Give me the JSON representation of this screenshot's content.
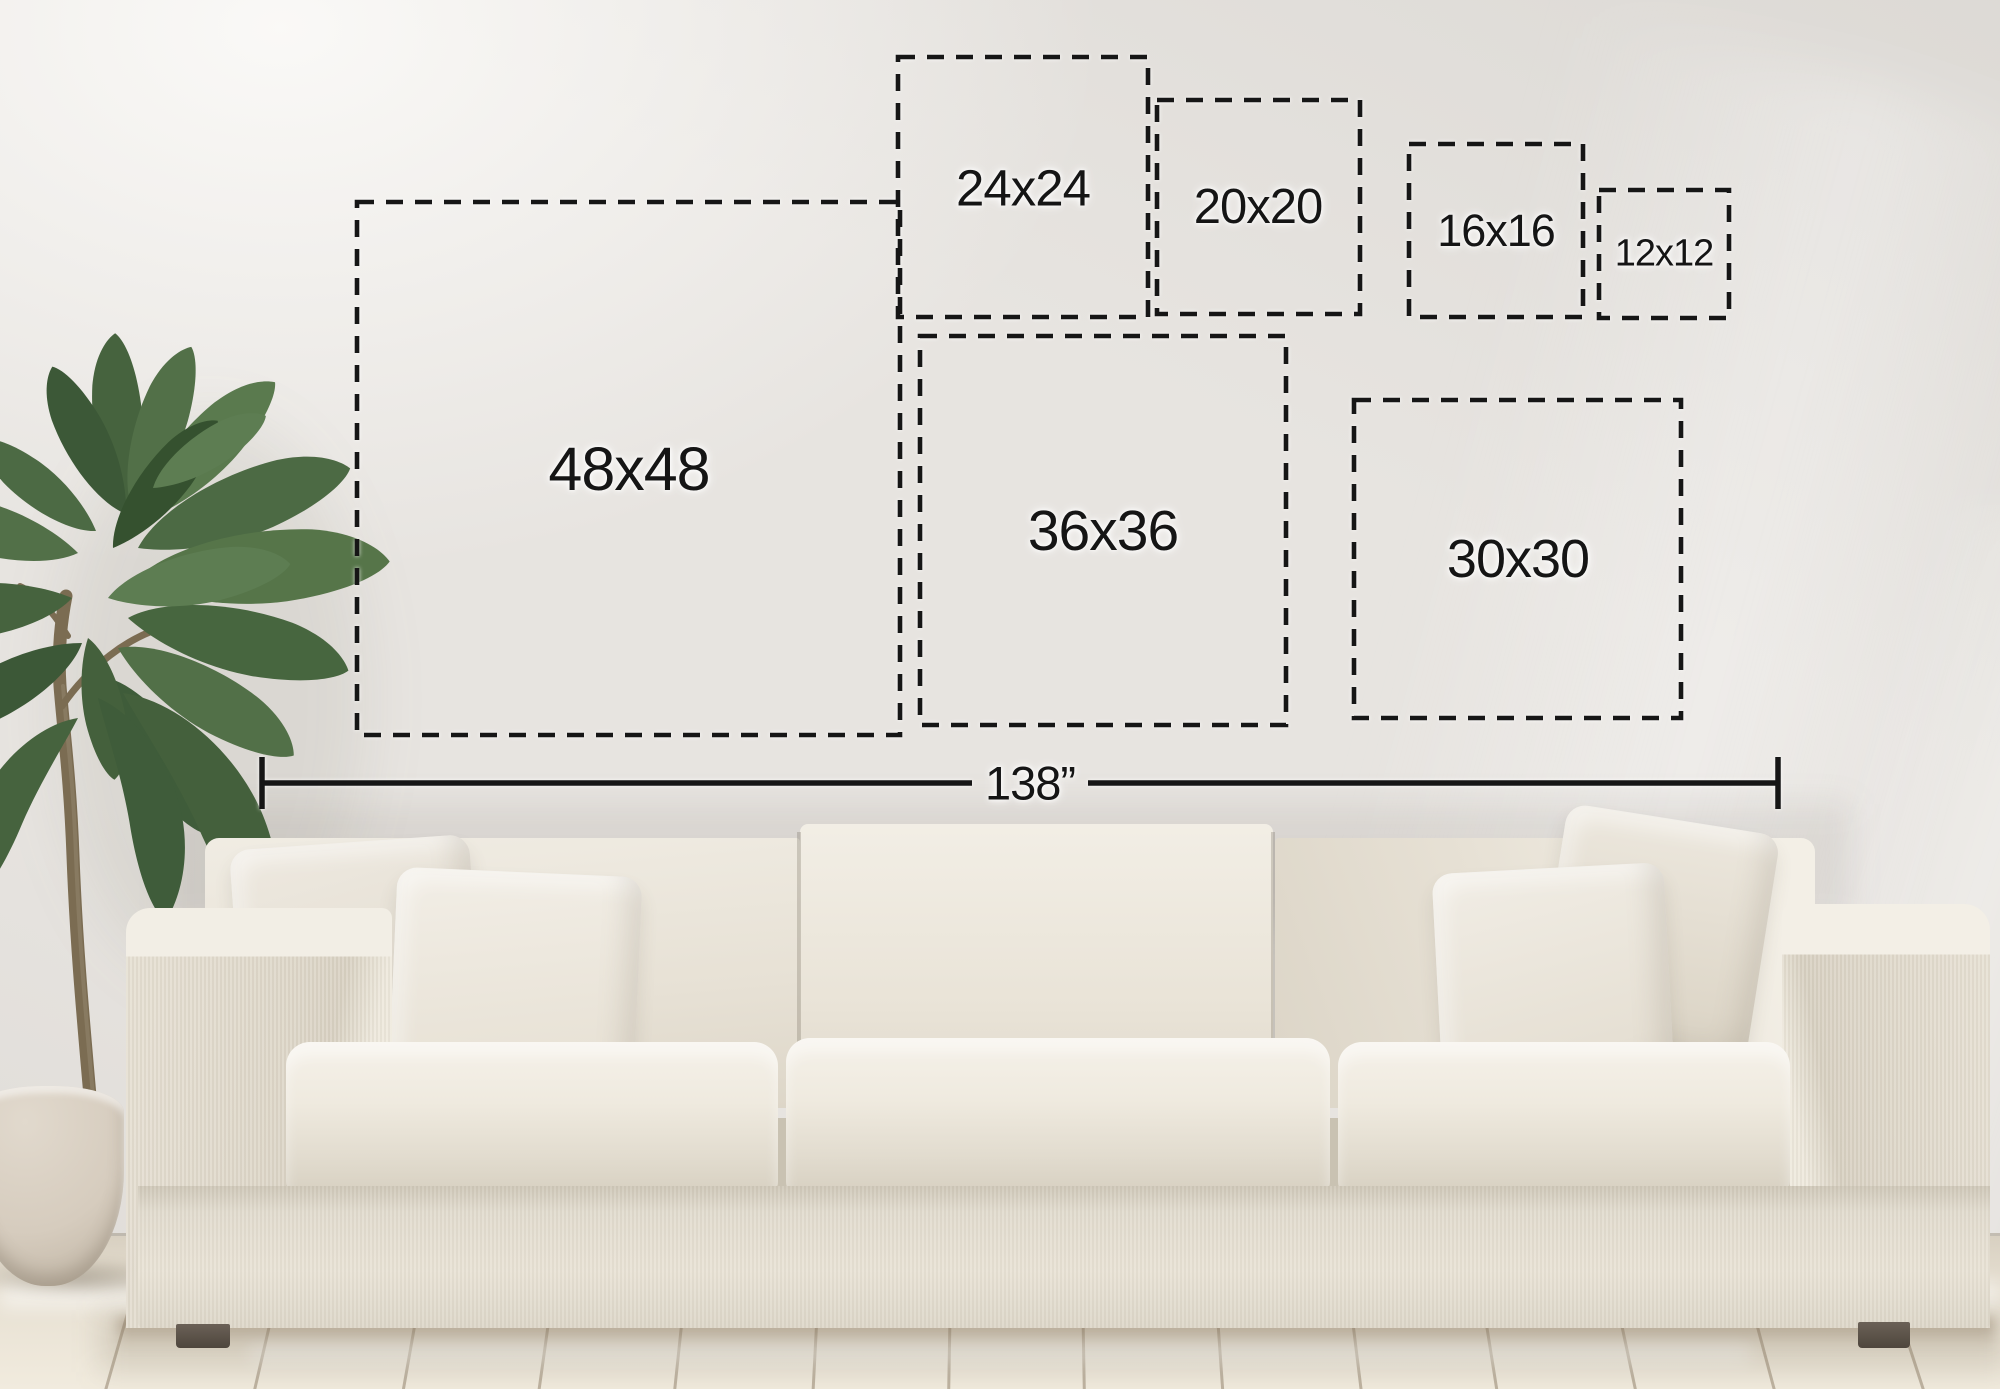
{
  "size_chart": {
    "boxes": [
      {
        "label": "48x48",
        "width_in": 48,
        "height_in": 48
      },
      {
        "label": "36x36",
        "width_in": 36,
        "height_in": 36
      },
      {
        "label": "30x30",
        "width_in": 30,
        "height_in": 30
      },
      {
        "label": "24x24",
        "width_in": 24,
        "height_in": 24
      },
      {
        "label": "20x20",
        "width_in": 20,
        "height_in": 20
      },
      {
        "label": "16x16",
        "width_in": 16,
        "height_in": 16
      },
      {
        "label": "12x12",
        "width_in": 12,
        "height_in": 12
      }
    ],
    "wall_width": {
      "label": "138”",
      "value_in": 138
    }
  },
  "scene": {
    "objects": {
      "sofa": "white three-seat fabric sofa",
      "plant": "potted green plant",
      "pot": "cream plant pot",
      "floor": "whitewashed wood plank floor",
      "wall": "plain light wall"
    }
  },
  "colors": {
    "dash_line": "#161616",
    "label_text": "#151515",
    "wall": "#e7e4e0",
    "floor": "#e9e2d5",
    "sofa_fabric": "#ebe6db",
    "pillow": "#efebe2",
    "leaf_green": "#4c6a44",
    "trunk": "#7b6c52",
    "pot": "#d6ccbe",
    "leg": "#564d43"
  }
}
